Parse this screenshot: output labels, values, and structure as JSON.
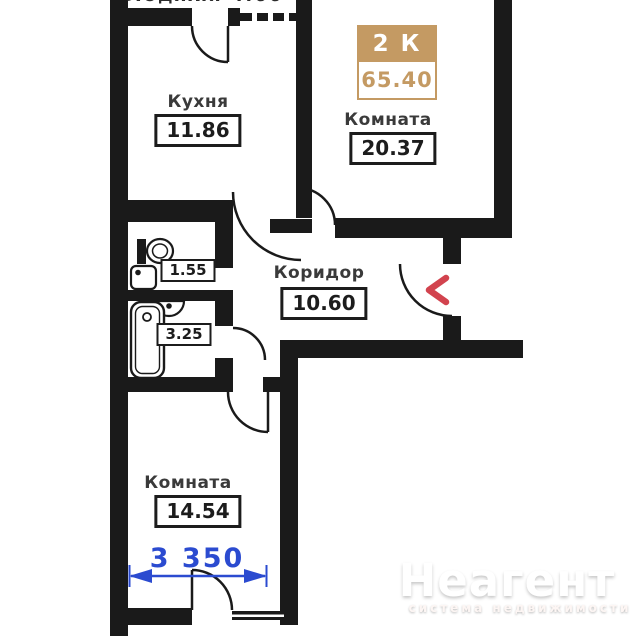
{
  "plan": {
    "badge": {
      "rooms": "2 К",
      "area": "65.40"
    },
    "top_cut": {
      "text": "Лоджия 4.66"
    },
    "kitchen": {
      "label": "Кухня",
      "area": "11.86"
    },
    "room_top": {
      "label": "Комната",
      "area": "20.37"
    },
    "corridor": {
      "label": "Коридор",
      "area": "10.60"
    },
    "wc": {
      "area": "1.55"
    },
    "bathroom": {
      "area": "3.25"
    },
    "room_bottom": {
      "label": "Комната",
      "area": "14.54"
    },
    "dimension": {
      "value": "3 350"
    }
  },
  "watermark": {
    "title": "Неагент",
    "subtitle": "система недвижимости"
  },
  "colors": {
    "wall": "#1a1a1a",
    "badge_tan": "#c49a63",
    "dimension_blue": "#2b4bd0",
    "entrance_arrow_red": "#d2434e",
    "background": "#ffffff"
  }
}
